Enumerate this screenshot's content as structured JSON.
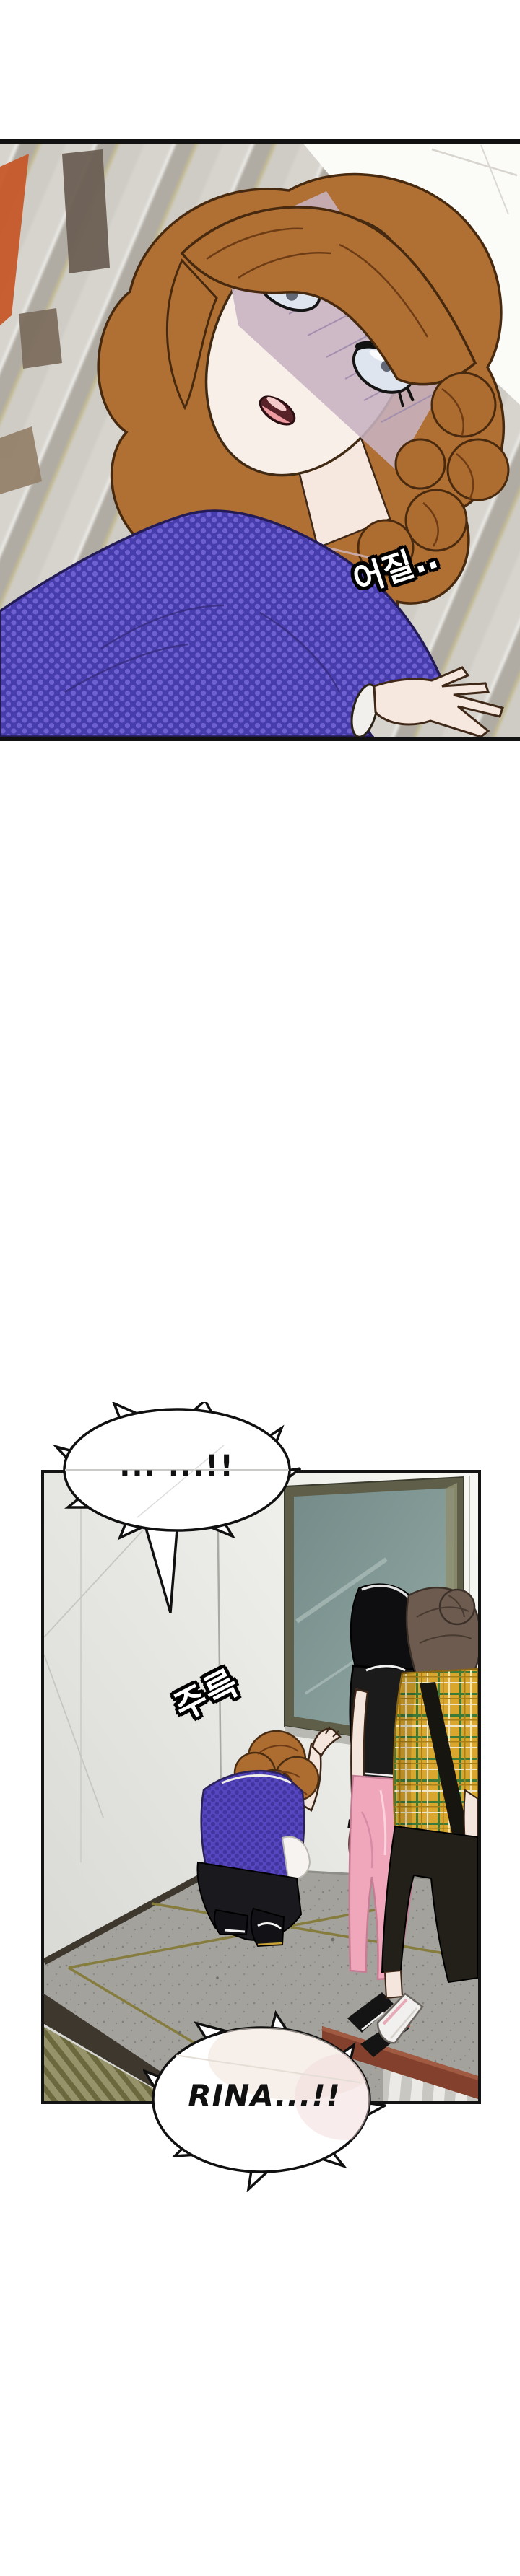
{
  "page": {
    "background": "#ffffff"
  },
  "panel1": {
    "sfx_dizzy": "어질.."
  },
  "panel2": {
    "bubble_silence": "... ...!!",
    "sfx_drip": "주륵",
    "bubble_rina": "RINA...!!"
  },
  "palette": {
    "panel_border": "#121212",
    "hair_orange": "#b06f33",
    "shirt_blue": "#473cab",
    "shirt_dot": "#6e60d0",
    "stair_grey": "#d7d4ce",
    "stair_tan": "#c3ba90",
    "rail_orange": "#c7592b",
    "door_glass": "#849a97",
    "door_frame": "#5e5e49",
    "floor_grey": "#a3a29c",
    "tape_olive": "#857c3e",
    "plaid_yellow": "#d9a62e",
    "plaid_green": "#3d7a37",
    "pants_pink": "#f1a7bb",
    "handrail_brown": "#82402d",
    "skin": "#f6e8df"
  }
}
